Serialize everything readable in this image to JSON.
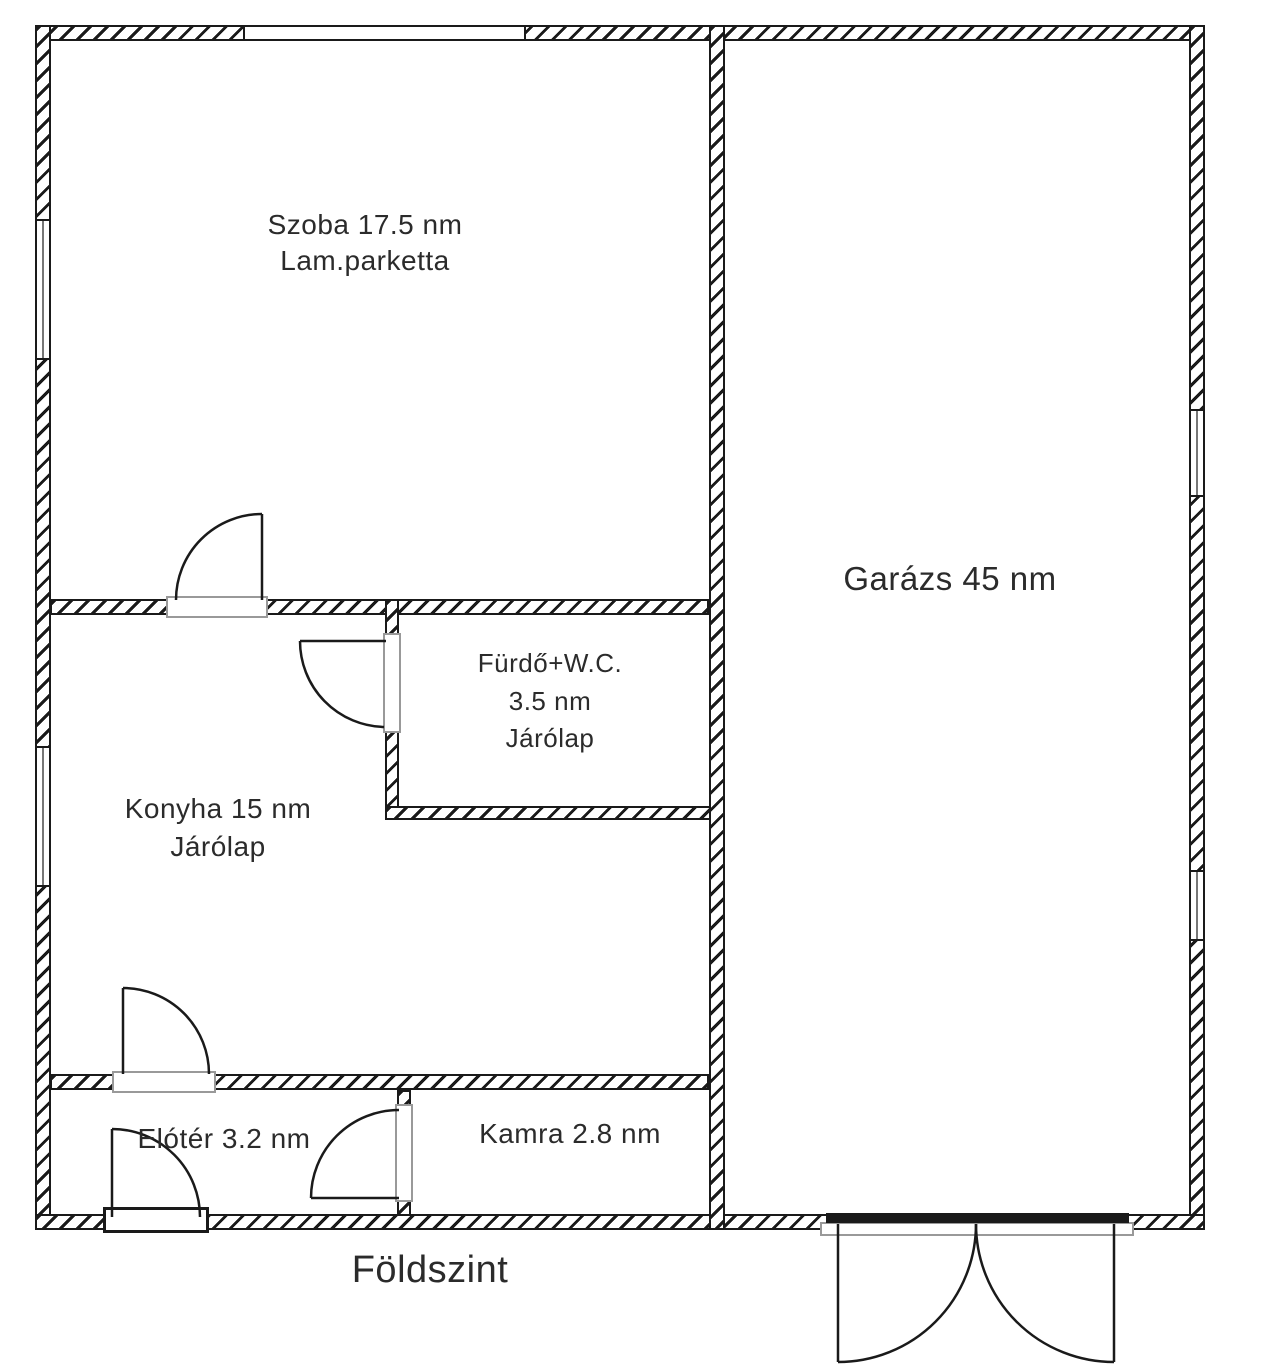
{
  "title": "Földszint",
  "rooms": {
    "szoba": {
      "label": "Szoba 17.5 nm",
      "floor": "Lam.parketta"
    },
    "garazs": {
      "label": "Garázs 45 nm"
    },
    "furdo": {
      "label": "Fürdő+W.C.",
      "area": "3.5 nm",
      "floor": "Járólap"
    },
    "konyha": {
      "label": "Konyha 15 nm",
      "floor": "Járólap"
    },
    "eloter": {
      "label": "Elótér 3.2 nm"
    },
    "kamra": {
      "label": "Kamra 2.8 nm"
    }
  },
  "colors": {
    "line": "#1a1a1a",
    "threshold_outline": "#999999",
    "background": "#ffffff"
  }
}
